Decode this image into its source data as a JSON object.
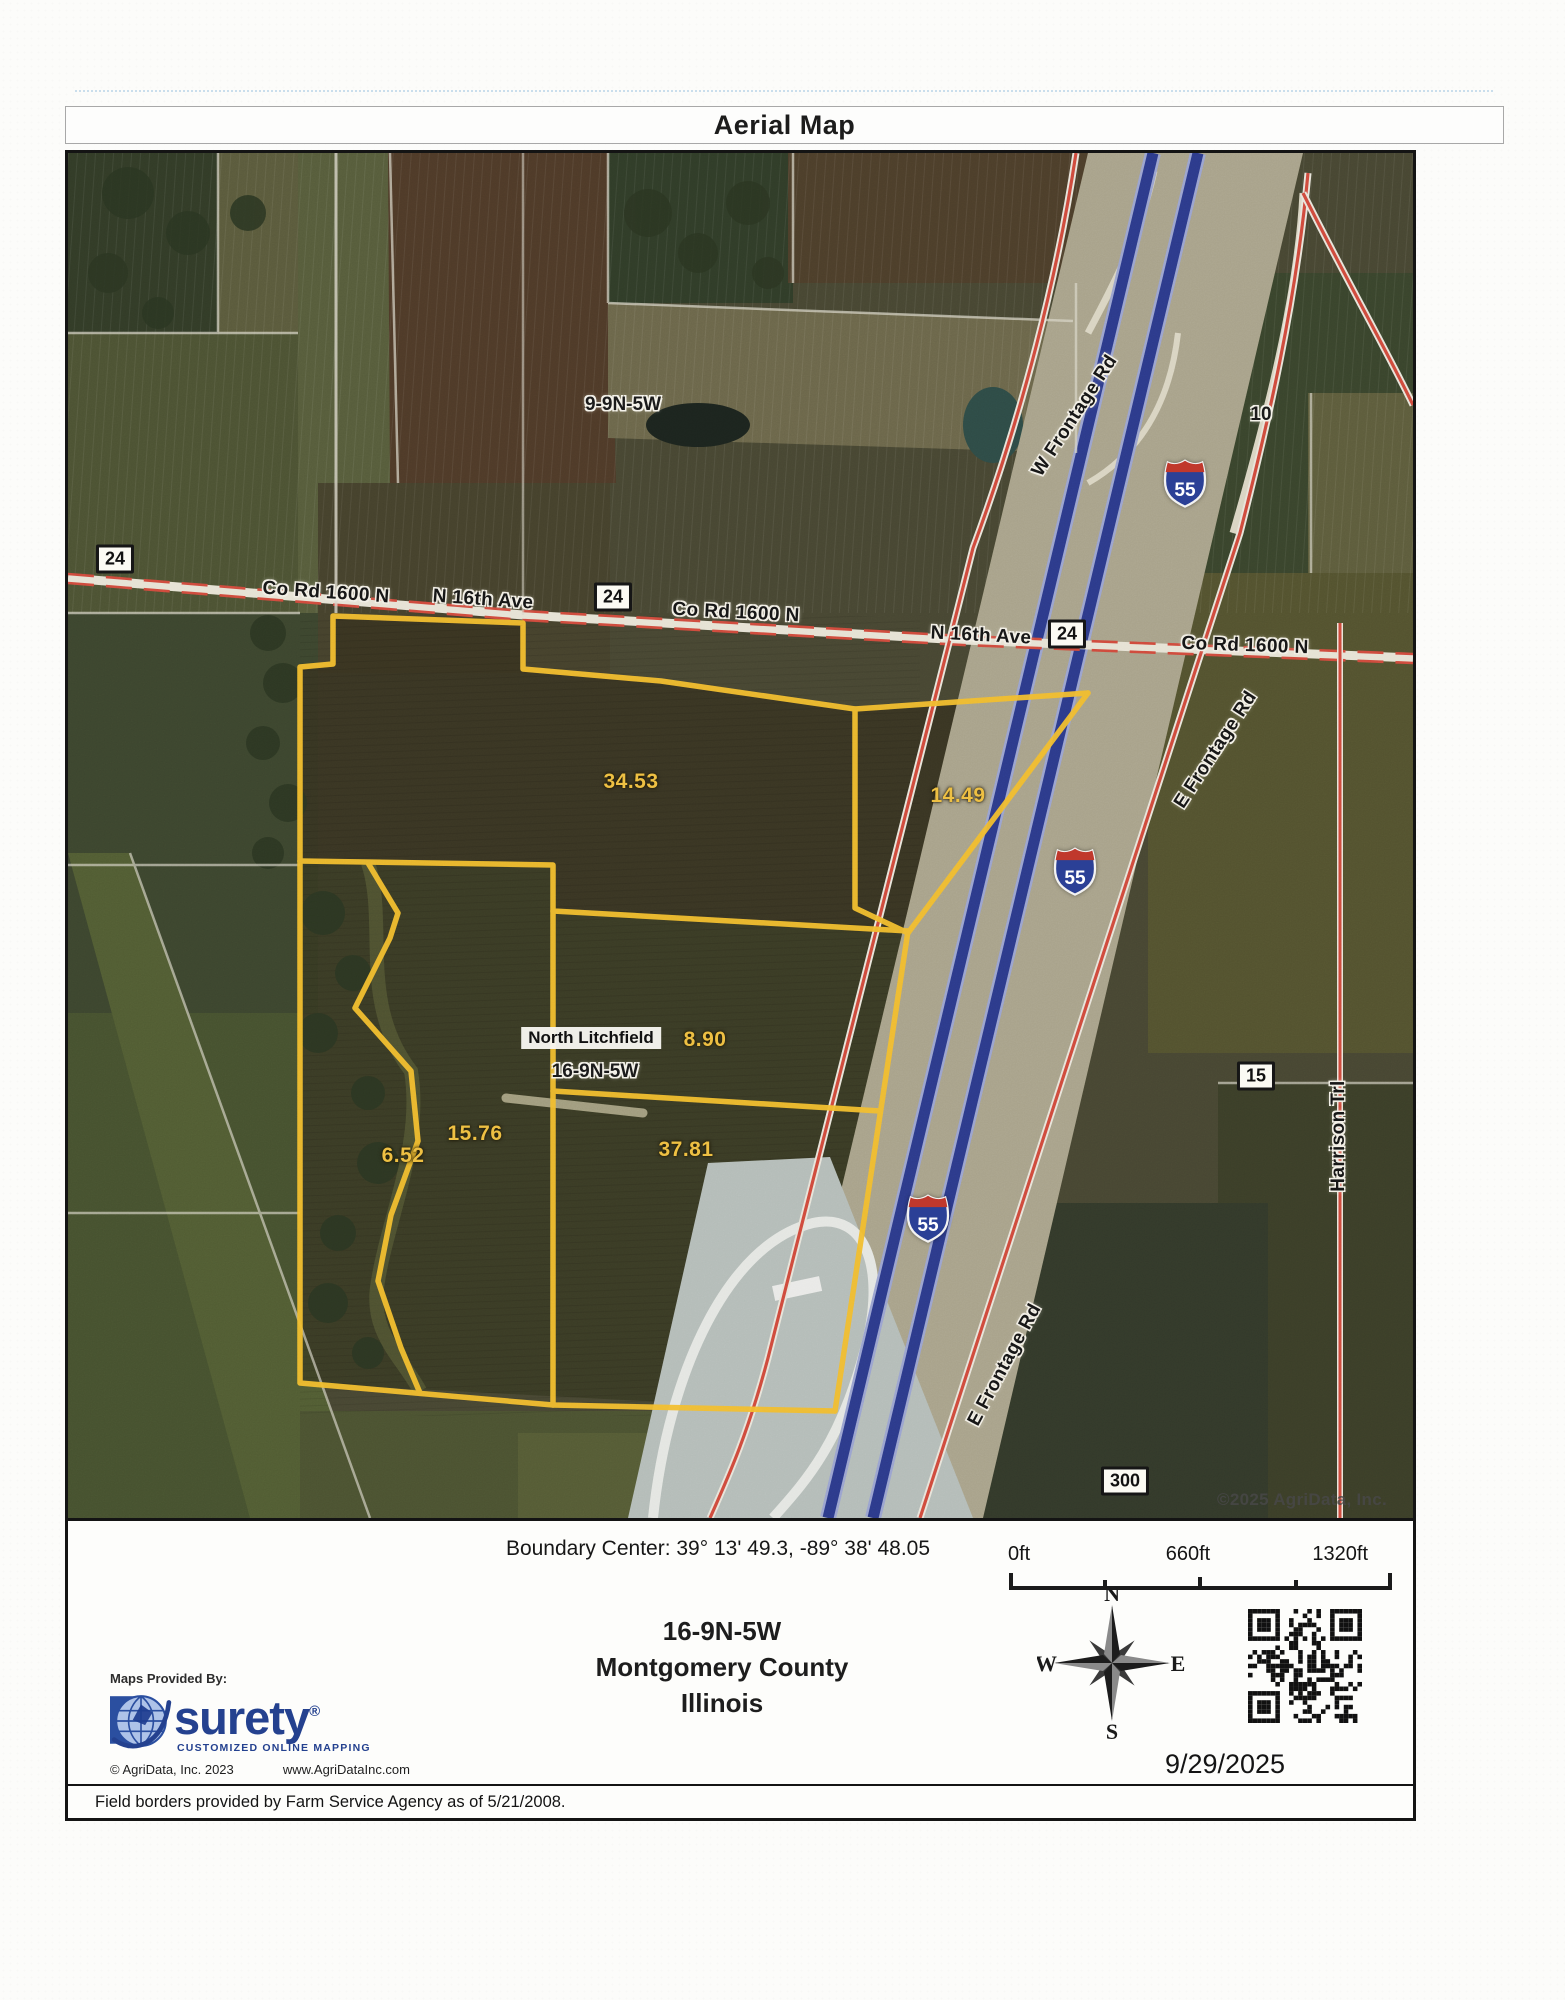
{
  "title": "Aerial Map",
  "map": {
    "labels": [
      {
        "text": "9-9N-5W",
        "x": 555,
        "y": 252,
        "style": "halo",
        "rot": 0
      },
      {
        "text": "Co Rd 1600 N",
        "x": 258,
        "y": 440,
        "style": "road",
        "rot": 4
      },
      {
        "text": "24",
        "x": 47,
        "y": 406,
        "style": "shield",
        "rot": 0
      },
      {
        "text": "N 16th Ave",
        "x": 415,
        "y": 447,
        "style": "road",
        "rot": 4
      },
      {
        "text": "24",
        "x": 545,
        "y": 444,
        "style": "shield",
        "rot": 0
      },
      {
        "text": "Co Rd 1600 N",
        "x": 668,
        "y": 460,
        "style": "road",
        "rot": 3
      },
      {
        "text": "N 16th Ave",
        "x": 913,
        "y": 483,
        "style": "road",
        "rot": 3
      },
      {
        "text": "24",
        "x": 999,
        "y": 481,
        "style": "shield",
        "rot": 0
      },
      {
        "text": "Co Rd 1600 N",
        "x": 1177,
        "y": 493,
        "style": "road",
        "rot": 2
      },
      {
        "text": "W Frontage Rd",
        "x": 1007,
        "y": 263,
        "style": "road",
        "rot": -57
      },
      {
        "text": "10",
        "x": 1193,
        "y": 262,
        "style": "halo",
        "rot": 0
      },
      {
        "text": "55",
        "x": 1117,
        "y": 330,
        "style": "i55",
        "rot": 0
      },
      {
        "text": "55",
        "x": 1007,
        "y": 718,
        "style": "i55",
        "rot": 0
      },
      {
        "text": "55",
        "x": 860,
        "y": 1065,
        "style": "i55",
        "rot": 0
      },
      {
        "text": "E Frontage Rd",
        "x": 1148,
        "y": 597,
        "style": "road",
        "rot": -57
      },
      {
        "text": "E Frontage Rd",
        "x": 937,
        "y": 1212,
        "style": "road",
        "rot": -62
      },
      {
        "text": "Harrison Trl",
        "x": 1271,
        "y": 983,
        "style": "road",
        "rot": -90
      },
      {
        "text": "15",
        "x": 1188,
        "y": 923,
        "style": "shield",
        "rot": 0
      },
      {
        "text": "300",
        "x": 1057,
        "y": 1328,
        "style": "shield",
        "rot": 0
      },
      {
        "text": "34.53",
        "x": 563,
        "y": 629,
        "style": "acre",
        "rot": 0
      },
      {
        "text": "14.49",
        "x": 890,
        "y": 643,
        "style": "acre",
        "rot": 0
      },
      {
        "text": "8.90",
        "x": 637,
        "y": 887,
        "style": "acre",
        "rot": 0
      },
      {
        "text": "15.76",
        "x": 407,
        "y": 981,
        "style": "acre",
        "rot": 0
      },
      {
        "text": "6.52",
        "x": 335,
        "y": 1003,
        "style": "acre",
        "rot": 0
      },
      {
        "text": "37.81",
        "x": 618,
        "y": 997,
        "style": "acre",
        "rot": 0
      },
      {
        "text": "North Litchfield",
        "x": 523,
        "y": 885,
        "style": "town",
        "rot": 0
      },
      {
        "text": "16-9N-5W",
        "x": 527,
        "y": 919,
        "style": "halo",
        "rot": 0
      },
      {
        "text": "©2025 AgriData, Inc.",
        "x": 1234,
        "y": 1347,
        "style": "credit",
        "rot": 0
      }
    ]
  },
  "footer": {
    "boundary_center": "Boundary Center: 39° 13' 49.3, -89° 38' 48.05",
    "scale_labels": [
      "0ft",
      "660ft",
      "1320ft"
    ],
    "section": "16-9N-5W",
    "county": "Montgomery County",
    "state": "Illinois",
    "date": "9/29/2025",
    "compass": {
      "n": "N",
      "e": "E",
      "s": "S",
      "w": "W"
    },
    "provider": {
      "heading": "Maps Provided By:",
      "brand": "surety",
      "registered": "®",
      "tagline": "CUSTOMIZED ONLINE MAPPING",
      "copyright": "© AgriData, Inc. 2023",
      "website": "www.AgriDataInc.com"
    },
    "disclaimer": "Field borders provided by Farm Service Agency as of 5/21/2008."
  }
}
